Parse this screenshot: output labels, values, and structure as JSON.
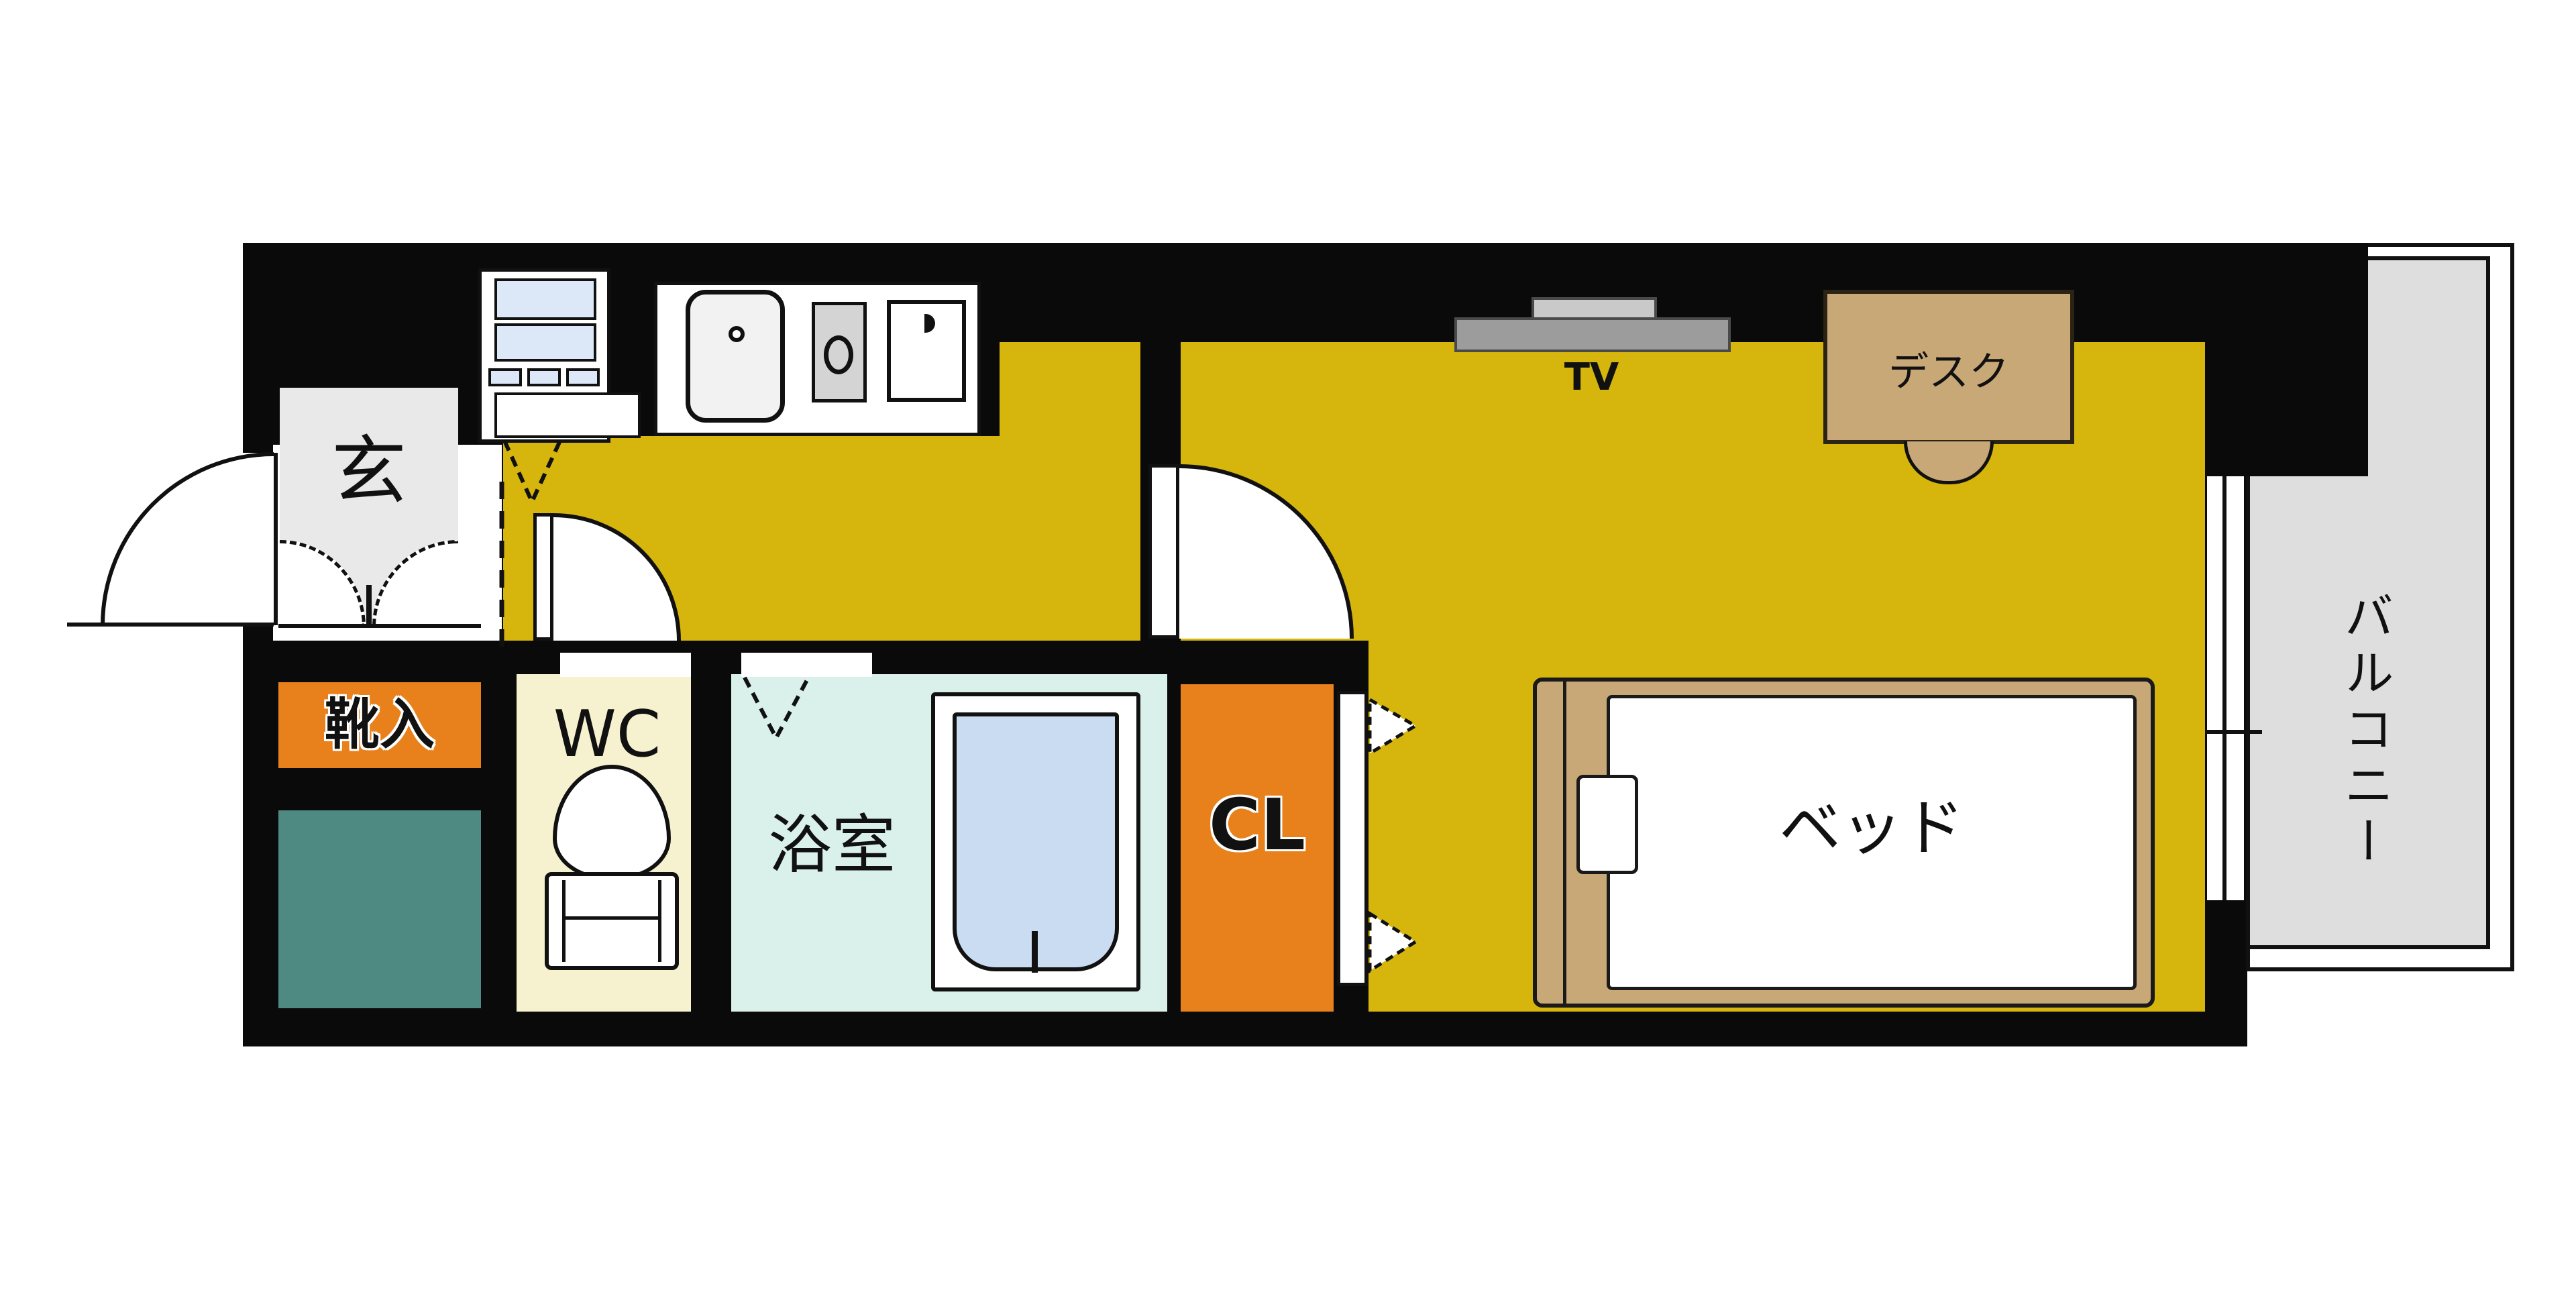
{
  "title": "ワンルーム間取り図 (studio apartment floor plan)",
  "labels": {
    "entrance": "玄",
    "shoe_storage": "靴入",
    "toilet": "WC",
    "bathroom": "浴室",
    "closet": "CL",
    "bed": "ベッド",
    "tv": "TV",
    "desk": "デスク",
    "balcony": "バルコニー"
  },
  "colors": {
    "wall": "#0a0a0a",
    "floor": "#d6b50d",
    "accent_orange": "#e8811c",
    "teal": "#4e8a82",
    "wc_floor": "#f6f2cf",
    "bath_floor": "#d9f1ea",
    "water": "#c9dcf2",
    "appliance_blue": "#dce7f8",
    "balcony_gray": "#dedede",
    "panel_gray": "#e9e9e9",
    "wood": "#c9a878",
    "tv_gray": "#9c9c9c",
    "tv_light": "#c9c9c9",
    "stove_gray": "#d4d4d4"
  }
}
